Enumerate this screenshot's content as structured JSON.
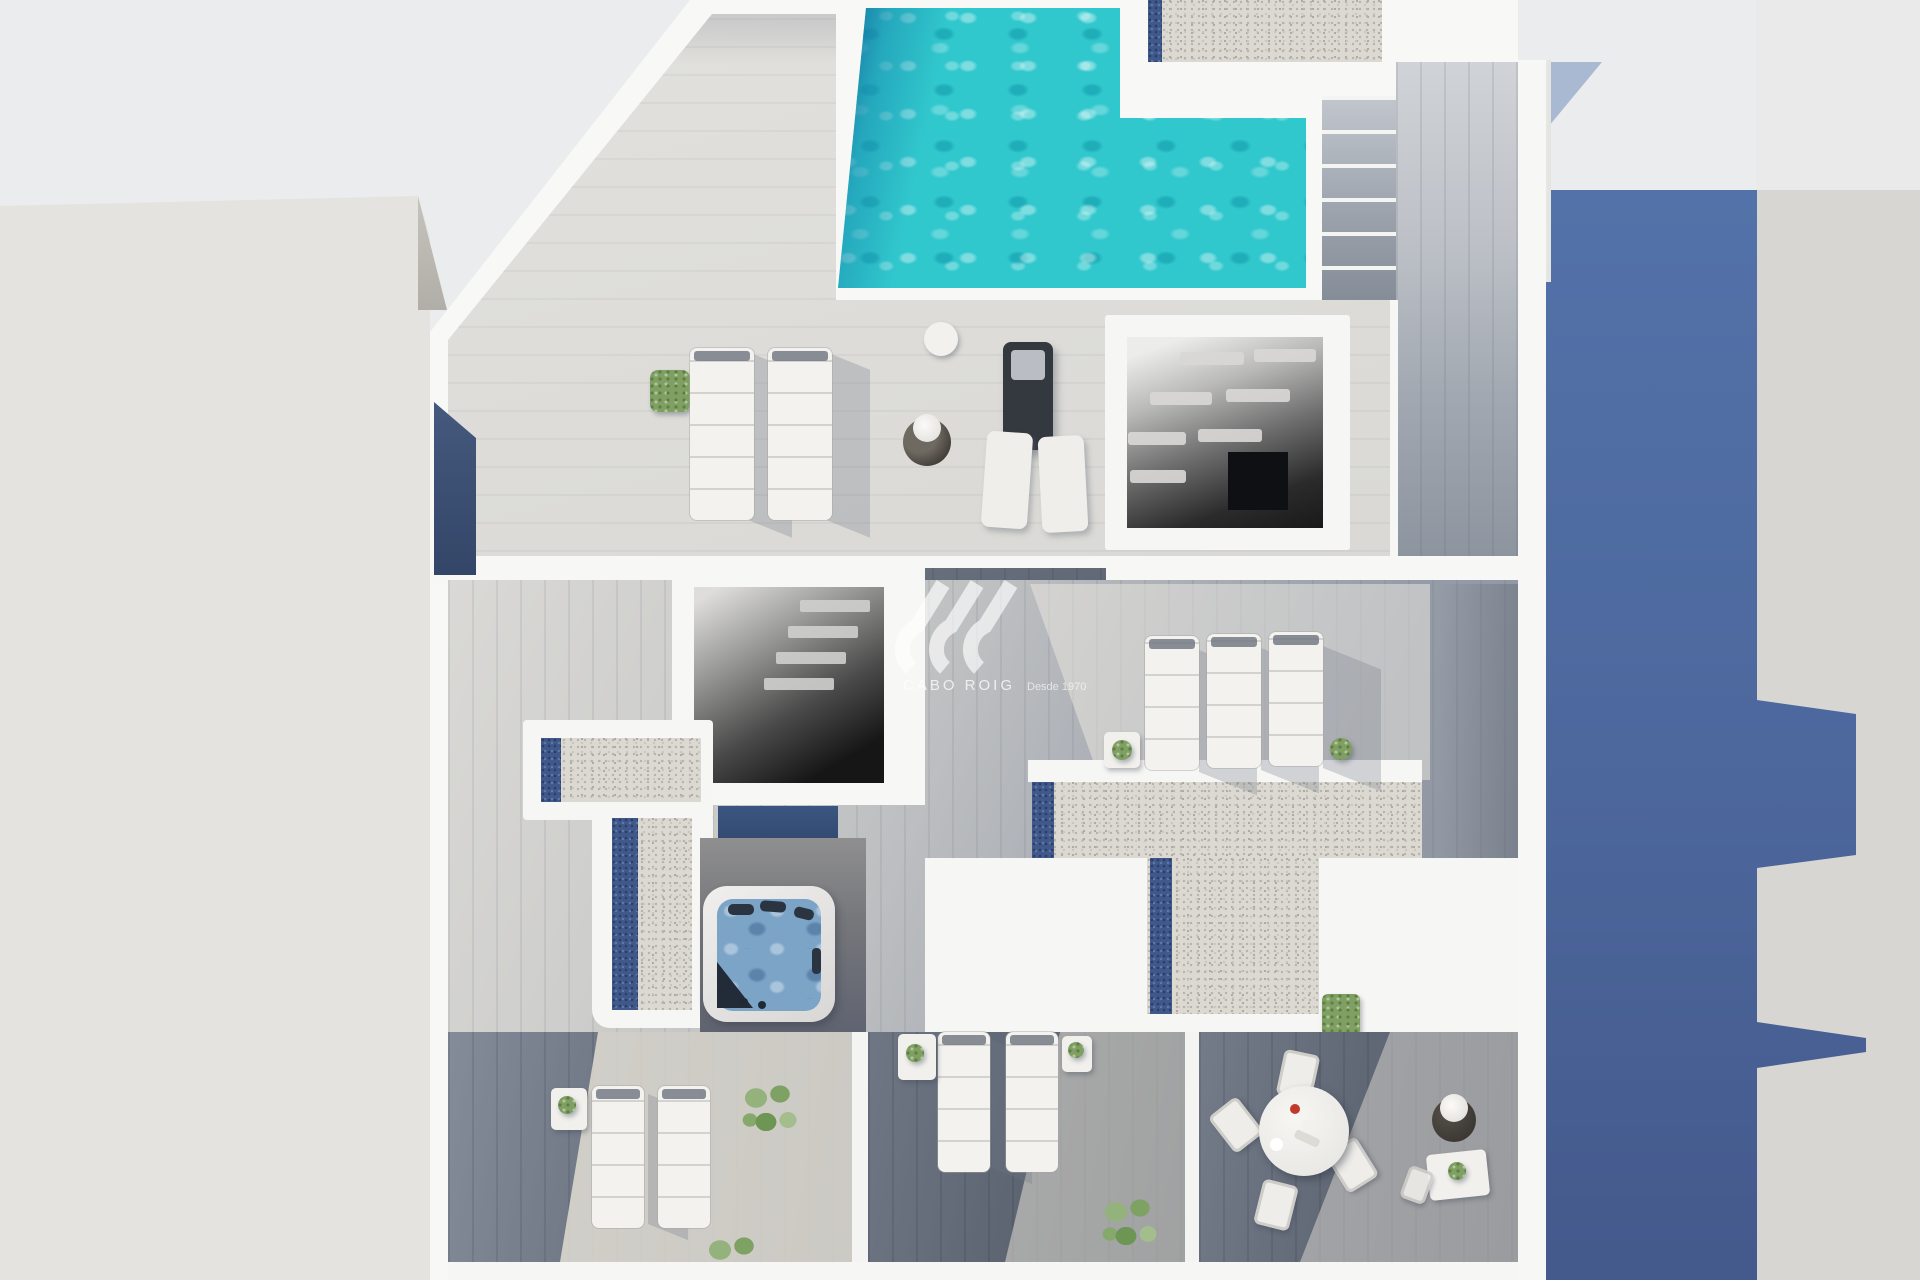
{
  "canvas": {
    "width": 1920,
    "height": 1280
  },
  "image_type": "aerial 3D architectural render of a penthouse rooftop solarium",
  "watermark": {
    "brand": "CABO ROIG",
    "tagline": "Desde 1970",
    "logo": "sv-wave-logo",
    "color": "#ffffff"
  },
  "palette": {
    "background": "#ebecee",
    "left_neighbor_roof": "#e5e3df",
    "right_neighbor_building": "#d7d6d2",
    "cast_shadow_blue": "#4c689d",
    "wall_white": "#f8f8f6",
    "pool_water": "#2ec7cc",
    "pool_shadow_band": "#1e6f9f",
    "gravel_roof": "#dcd9d2",
    "pebble_strip_blue": "#41598a",
    "wood_light": "#dcdbd7",
    "wood_mid": "#9aa0a8",
    "wood_dark": "#4e5866",
    "jacuzzi_water": "#7ba4c7",
    "plant_green": "#7f9f63"
  },
  "scene": {
    "pool": {
      "label": "swimming pool with rippled turquoise water"
    },
    "stairs": {
      "label": "exterior staircase beside pool"
    },
    "stairwell_louvered": {
      "label": "open stairwell shaft with louver slats"
    },
    "stairwell_open": {
      "label": "open stairwell shaft"
    },
    "jacuzzi": {
      "label": "square hot tub with headrests"
    },
    "pergola_l_shaped": {
      "label": "L-shaped gravel roof with blue pebble strip"
    },
    "pergola_t_shaped": {
      "label": "T-shaped gravel roof with blue pebble strips"
    },
    "loungers": {
      "upper_terrace": 2,
      "flat_pair": 2,
      "right_terrace": 3,
      "bottom_left": 2,
      "bottom_middle": 2
    },
    "dining": {
      "table": "round white table",
      "chairs": 4,
      "accessories": "red bowl, plates, planter with white flowers, side table with plant"
    },
    "plants": {
      "square_shrub": 1,
      "topiaries": 4,
      "leafy_bushes": 4,
      "grass_patch": 1
    }
  }
}
